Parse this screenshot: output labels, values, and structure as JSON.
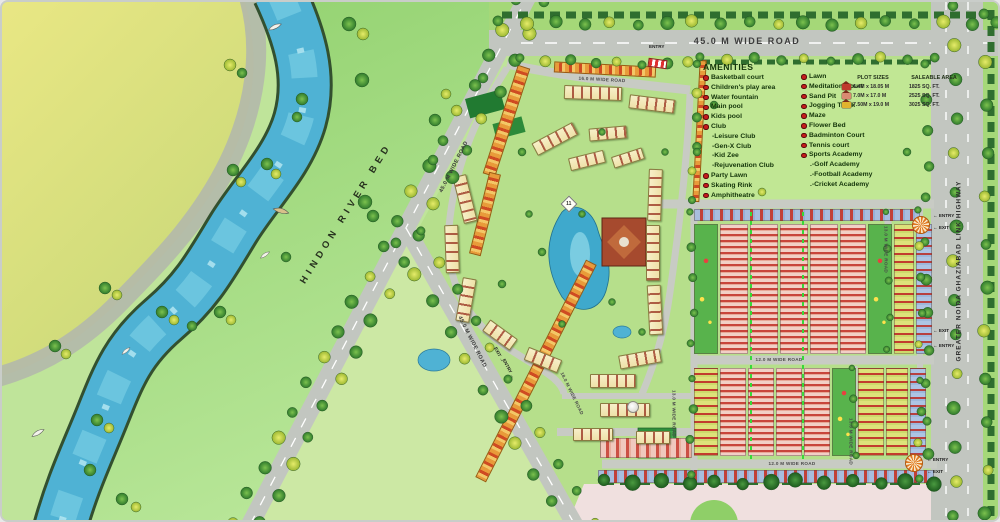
{
  "map": {
    "river_label": "HINDON RIVER BED",
    "highway_label": "GREATER NOIDA GHAZIABAD LINK HIGHWAY",
    "roads": {
      "top": "45.0 M WIDE ROAD",
      "diagonal_north": "45.0 M WIDE ROAD",
      "diagonal_south": "45.0 M WIDE ROAD",
      "internal_16": "16.0 M WIDE ROAD",
      "internal_18": "18.0 M WIDE ROAD",
      "internal_12_mid": "12.0 M WIDE ROAD",
      "internal_12_south": "12.0 M WIDE ROAD",
      "internal_13_east": "13.0 M WIDE ROAD",
      "internal_13_south": "13.0 M WIDE ROAD",
      "internal_13_west": "13.0 M WIDE ROAD"
    },
    "building_marker": "11"
  },
  "legend": {
    "header": "AMENITIES",
    "col1": [
      {
        "label": "Basketball court",
        "bullet": true
      },
      {
        "label": "Children's play area",
        "bullet": true
      },
      {
        "label": "Water fountain",
        "bullet": true
      },
      {
        "label": "Main pool",
        "bullet": true
      },
      {
        "label": "Kids pool",
        "bullet": true
      },
      {
        "label": "Club",
        "bullet": true
      },
      {
        "label": "-Leisure Club",
        "bullet": false
      },
      {
        "label": "-Gen-X Club",
        "bullet": false
      },
      {
        "label": "-Kid Zee",
        "bullet": false
      },
      {
        "label": "-Rejuvenation Club",
        "bullet": false
      },
      {
        "label": "Party Lawn",
        "bullet": true
      },
      {
        "label": "Skating Rink",
        "bullet": true
      },
      {
        "label": "Amphitheatre",
        "bullet": true
      }
    ],
    "col2": [
      {
        "label": "Lawn",
        "bullet": true
      },
      {
        "label": "Meditation Court",
        "bullet": true
      },
      {
        "label": "Sand Pit",
        "bullet": true
      },
      {
        "label": "Jogging Track",
        "bullet": true
      },
      {
        "label": "Maze",
        "bullet": true
      },
      {
        "label": "Flower Bed",
        "bullet": true
      },
      {
        "label": "Badminton Court",
        "bullet": true
      },
      {
        "label": "Tennis court",
        "bullet": true
      },
      {
        "label": "Sports Academy",
        "bullet": true
      },
      {
        "label": ".-Golf Academy",
        "bullet": false
      },
      {
        "label": ".-Football Academy",
        "bullet": false
      },
      {
        "label": ".-Cricket Academy",
        "bullet": false
      }
    ]
  },
  "plot_table": {
    "col1_header": "PLOT SIZES",
    "col2_header": "SALEABLE AREA",
    "rows": [
      {
        "size": "6.4M x 18.05 M",
        "area": "1825 SQ. FT.",
        "color": "#c03a2e"
      },
      {
        "size": "7.0M x 17.0 M",
        "area": "2525 SQ. FT.",
        "color": "#d98a72"
      },
      {
        "size": "7.50M x 19.0 M",
        "area": "3025 SQ. FT.",
        "color": "#e0b32e"
      }
    ]
  },
  "markers": {
    "entry_exits": [
      {
        "x": 931,
        "y": 211,
        "r": 0,
        "t": "← ENTRY"
      },
      {
        "x": 931,
        "y": 223,
        "r": 0,
        "t": "← EXIT"
      },
      {
        "x": 931,
        "y": 326,
        "r": 0,
        "t": "← EXIT"
      },
      {
        "x": 931,
        "y": 341,
        "r": 0,
        "t": "← ENTRY"
      },
      {
        "x": 925,
        "y": 455,
        "r": 0,
        "t": "← ENTRY"
      },
      {
        "x": 925,
        "y": 467,
        "r": 0,
        "t": "← EXIT"
      },
      {
        "x": 489,
        "y": 350,
        "r": 62,
        "t": "EXIT →"
      },
      {
        "x": 496,
        "y": 364,
        "r": 62,
        "t": "ENTRY →"
      },
      {
        "x": 647,
        "y": 42,
        "r": 0,
        "t": "ENTRY"
      }
    ]
  },
  "colors": {
    "water": "#4fb2d4",
    "road": "#c2c6c0",
    "field_yellow": "#e3e58a",
    "lawn_green": "#c1e794",
    "interior_green": "#b6df8b",
    "outside_pink": "#f0e0df",
    "legend_text": "#14350a",
    "bullet_red": "#c41c1c"
  },
  "decor": {
    "tree_rows": [
      [
        516,
        0,
        231,
        519,
        20,
        6,
        "m"
      ],
      [
        544,
        2,
        259,
        521,
        19,
        6,
        "m"
      ],
      [
        396,
        243,
        566,
        529,
        11,
        6,
        "m"
      ],
      [
        421,
        231,
        591,
        519,
        11,
        5,
        "m"
      ],
      [
        498,
        21,
        996,
        21,
        19,
        6,
        "m"
      ],
      [
        520,
        58,
        688,
        62,
        8,
        5,
        "m"
      ],
      [
        700,
        57,
        932,
        57,
        10,
        5,
        "m"
      ],
      [
        953,
        6,
        953,
        516,
        15,
        6,
        "m"
      ],
      [
        984,
        14,
        984,
        512,
        12,
        6,
        "m"
      ],
      [
        925,
        64,
        925,
        196,
        5,
        5,
        "g"
      ],
      [
        925,
        242,
        925,
        452,
        7,
        5,
        "g"
      ],
      [
        604,
        480,
        932,
        480,
        13,
        7,
        "d"
      ],
      [
        697,
        64,
        690,
        196,
        6,
        4.5,
        "m"
      ],
      [
        690,
        212,
        690,
        472,
        9,
        4,
        "g"
      ],
      [
        852,
        368,
        852,
        452,
        4,
        3.5,
        "g"
      ],
      [
        886,
        212,
        886,
        348,
        5,
        3.5,
        "g"
      ],
      [
        918,
        210,
        918,
        476,
        9,
        4,
        "m"
      ]
    ],
    "trees": [
      [
        347,
        22,
        7,
        "g"
      ],
      [
        361,
        32,
        6,
        "y"
      ],
      [
        228,
        63,
        6,
        "y"
      ],
      [
        240,
        71,
        5,
        "g"
      ],
      [
        360,
        78,
        7,
        "g"
      ],
      [
        300,
        97,
        6,
        "g"
      ],
      [
        295,
        115,
        5,
        "g"
      ],
      [
        231,
        168,
        6,
        "g"
      ],
      [
        239,
        180,
        5,
        "y"
      ],
      [
        363,
        200,
        7,
        "g"
      ],
      [
        371,
        214,
        6,
        "g"
      ],
      [
        265,
        162,
        6,
        "g"
      ],
      [
        274,
        172,
        5,
        "y"
      ],
      [
        160,
        310,
        6,
        "g"
      ],
      [
        172,
        318,
        5,
        "y"
      ],
      [
        103,
        286,
        6,
        "g"
      ],
      [
        115,
        293,
        5,
        "y"
      ],
      [
        53,
        344,
        6,
        "g"
      ],
      [
        64,
        352,
        5,
        "y"
      ],
      [
        95,
        418,
        6,
        "g"
      ],
      [
        107,
        426,
        5,
        "y"
      ],
      [
        88,
        468,
        6,
        "g"
      ],
      [
        120,
        497,
        6,
        "g"
      ],
      [
        134,
        505,
        5,
        "y"
      ],
      [
        218,
        310,
        6,
        "g"
      ],
      [
        229,
        318,
        5,
        "y"
      ],
      [
        190,
        324,
        5,
        "g"
      ],
      [
        284,
        255,
        5,
        "g"
      ],
      [
        433,
        118,
        6,
        "g"
      ],
      [
        444,
        92,
        5,
        "y"
      ],
      [
        431,
        158,
        5,
        "g"
      ],
      [
        481,
        76,
        5,
        "g"
      ],
      [
        520,
        150,
        4,
        "g"
      ],
      [
        600,
        130,
        3.5,
        "g"
      ],
      [
        663,
        150,
        3.5,
        "g"
      ],
      [
        540,
        250,
        4,
        "g"
      ],
      [
        610,
        300,
        3.5,
        "g"
      ],
      [
        560,
        322,
        3.5,
        "g"
      ],
      [
        640,
        330,
        3.5,
        "g"
      ],
      [
        500,
        282,
        4,
        "g"
      ],
      [
        580,
        212,
        3.5,
        "g"
      ],
      [
        527,
        212,
        3.5,
        "g"
      ],
      [
        695,
        150,
        4,
        "g"
      ],
      [
        760,
        190,
        4,
        "y"
      ],
      [
        905,
        150,
        4,
        "g"
      ],
      [
        712,
        103,
        4,
        "g"
      ]
    ],
    "boats": [
      [
        273,
        25,
        -25,
        1,
        "b"
      ],
      [
        279,
        209,
        15,
        1.15,
        "r"
      ],
      [
        263,
        253,
        -35,
        0.8,
        "b"
      ],
      [
        124,
        349,
        -40,
        0.75,
        "b"
      ],
      [
        36,
        431,
        -30,
        1,
        "b"
      ]
    ],
    "clusters": [
      [
        590,
        90,
        56,
        12,
        2
      ],
      [
        649,
        101,
        44,
        12,
        7
      ],
      [
        552,
        136,
        44,
        12,
        -28
      ],
      [
        584,
        157,
        34,
        11,
        -14
      ],
      [
        462,
        196,
        12,
        46,
        -14
      ],
      [
        449,
        246,
        12,
        46,
        -2
      ],
      [
        463,
        297,
        12,
        42,
        10
      ],
      [
        497,
        332,
        32,
        12,
        36
      ],
      [
        540,
        357,
        34,
        12,
        22
      ],
      [
        652,
        192,
        12,
        50,
        2
      ],
      [
        650,
        250,
        12,
        54,
        0
      ],
      [
        652,
        307,
        12,
        48,
        -3
      ],
      [
        637,
        356,
        40,
        12,
        -10
      ],
      [
        610,
        378,
        44,
        12,
        0
      ],
      [
        622,
        407,
        48,
        12,
        0
      ],
      [
        590,
        431,
        38,
        11,
        0
      ],
      [
        650,
        434,
        32,
        11,
        0
      ],
      [
        605,
        130,
        36,
        11,
        -5
      ],
      [
        625,
        155,
        30,
        10,
        -18
      ]
    ],
    "plot_bands": [
      {
        "x": 692,
        "y": 207,
        "h": 12,
        "lane": 0,
        "cols": [
          {
            "w": 226,
            "t": "shopblue"
          }
        ]
      },
      {
        "x": 692,
        "y": 222,
        "h": 130,
        "lane": 2,
        "cols": [
          {
            "w": 24,
            "t": "park"
          },
          {
            "w": 28,
            "t": "pink"
          },
          {
            "w": 28,
            "t": "pink"
          },
          {
            "w": 28,
            "t": "pink"
          },
          {
            "w": 28,
            "t": "pink"
          },
          {
            "w": 26,
            "t": "pink"
          },
          {
            "w": 24,
            "t": "park"
          },
          {
            "w": 20,
            "t": "yellow"
          },
          {
            "w": 16,
            "t": "blue"
          }
        ]
      },
      {
        "x": 692,
        "y": 366,
        "h": 88,
        "lane": 2,
        "cols": [
          {
            "w": 24,
            "t": "yellow"
          },
          {
            "w": 26,
            "t": "pink"
          },
          {
            "w": 26,
            "t": "pink"
          },
          {
            "w": 26,
            "t": "pink"
          },
          {
            "w": 26,
            "t": "pink"
          },
          {
            "w": 24,
            "t": "park"
          },
          {
            "w": 26,
            "t": "yellow"
          },
          {
            "w": 22,
            "t": "yellow"
          },
          {
            "w": 16,
            "t": "blue"
          }
        ]
      },
      {
        "x": 598,
        "y": 436,
        "h": 20,
        "lane": 0,
        "cols": [
          {
            "w": 92,
            "t": "pinksmall"
          }
        ]
      },
      {
        "x": 596,
        "y": 468,
        "h": 13,
        "lane": 0,
        "cols": [
          {
            "w": 336,
            "t": "shopblue"
          }
        ]
      }
    ],
    "strips": [
      {
        "x": 498,
        "y": 62,
        "w": 11,
        "h": 112,
        "r": 18,
        "v": true
      },
      {
        "x": 477,
        "y": 170,
        "w": 10,
        "h": 82,
        "r": 14,
        "v": true
      },
      {
        "x": 528,
        "y": 247,
        "w": 10,
        "h": 242,
        "r": 27,
        "v": true
      },
      {
        "x": 552,
        "y": 62,
        "w": 100,
        "h": 9,
        "r": 3,
        "v": false
      },
      {
        "x": 694,
        "y": 58,
        "w": 5,
        "h": 140,
        "r": 3,
        "v": true
      }
    ],
    "walks": [
      {
        "x": 748,
        "y": 210,
        "h": 252
      },
      {
        "x": 800,
        "y": 210,
        "h": 252
      }
    ],
    "sunbursts": [
      {
        "x": 910,
        "y": 214
      },
      {
        "x": 903,
        "y": 452
      }
    ]
  }
}
